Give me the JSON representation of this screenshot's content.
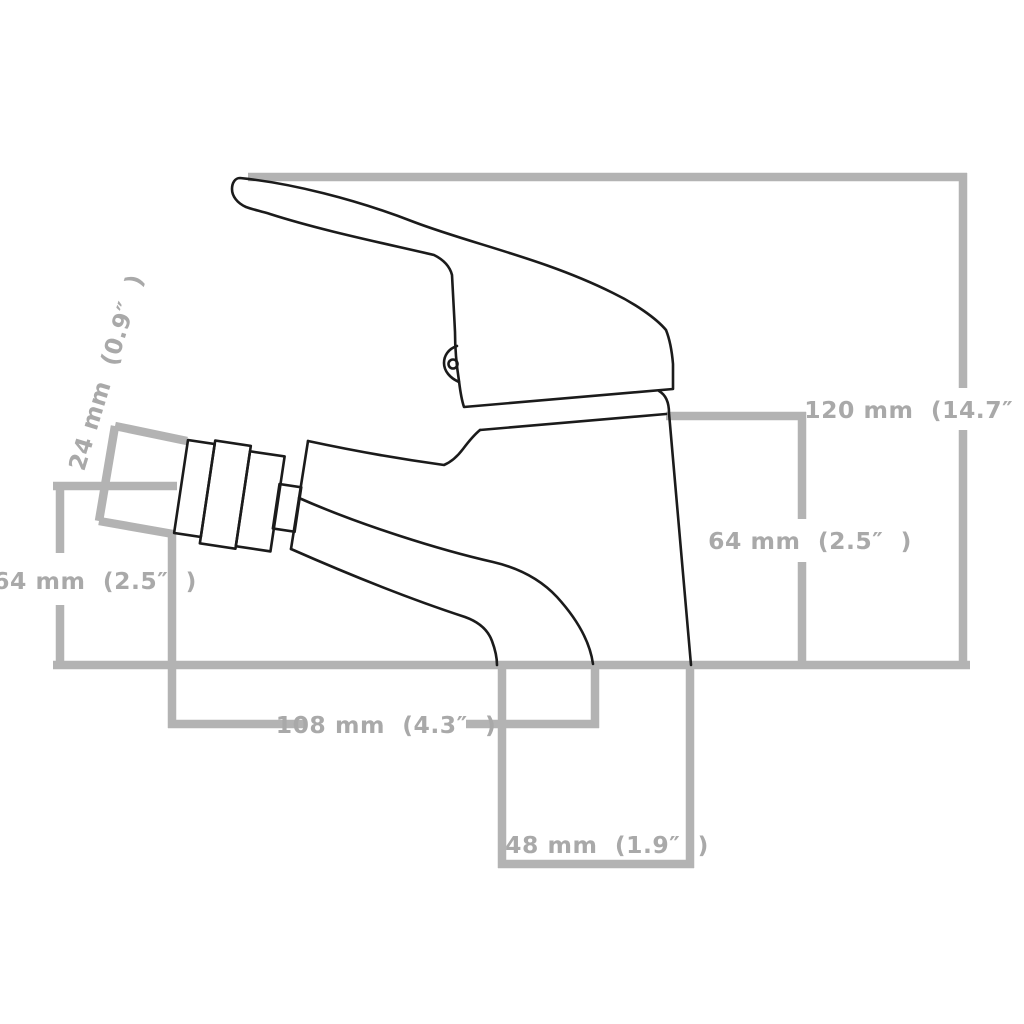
{
  "figure": {
    "title": "Bidet basin mixer faucet — dimension diagram, side profile",
    "type": "technical-dimension-drawing",
    "background_color": "#ffffff",
    "dimension_line_color": "#b3b3b3",
    "dimension_text_color": "#a9a9a9",
    "outline_color": "#1b1b1b"
  },
  "dimensions": {
    "total_height": "120 mm  (14.7″  )",
    "spout_height_right": "64 mm  (2.5″  )",
    "spout_height_left": "64 mm  (2.5″  )",
    "nozzle_diameter": "24 mm  (0.9″  )",
    "reach": "108 mm  (4.3″  )",
    "base_width": "48 mm  (1.9″  )"
  }
}
